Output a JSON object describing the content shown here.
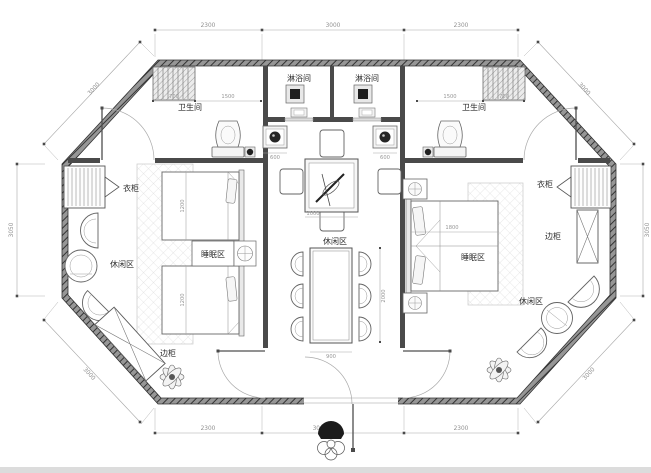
{
  "plan": {
    "rooms": {
      "bathroom_left": "卫生间",
      "bathroom_right": "卫生间",
      "shower_left": "淋浴间",
      "shower_right": "淋浴间",
      "sleep_left": "睡眠区",
      "sleep_right": "睡眠区",
      "leisure_left": "休闲区",
      "leisure_center": "休闲区",
      "leisure_right": "休闲区"
    },
    "furniture": {
      "wardrobe_left": "衣柜",
      "wardrobe_right": "衣柜",
      "side_cabinet_left": "边柜",
      "side_cabinet_right": "边柜"
    },
    "dims": {
      "top": [
        "2300",
        "3000",
        "2300"
      ],
      "bottom": [
        "2300",
        "3000",
        "2300"
      ],
      "side_left": "3050",
      "side_right": "3050",
      "diag_top_left": "3000",
      "diag_top_right": "3000",
      "diag_bottom_left": "3000",
      "diag_bottom_right": "3000",
      "interior": {
        "tray_left_w": "700",
        "bath_left_w": "1500",
        "bath_right_w": "1500",
        "tray_right_w": "700",
        "basin_left_w": "600",
        "basin_right_w": "600",
        "tea_table_w": "1000",
        "dining_l": "2000",
        "dining_w": "900",
        "bed_left_top": "1200",
        "bed_left_bottom": "1200",
        "bed_right_w": "1800"
      }
    },
    "colors": {
      "wall": "#8e8e8e",
      "wall_line": "#3a3a3a",
      "furniture_line": "#636363",
      "dim": "#8f8f8f",
      "label": "#2d2d2d",
      "background": "#ffffff"
    }
  }
}
